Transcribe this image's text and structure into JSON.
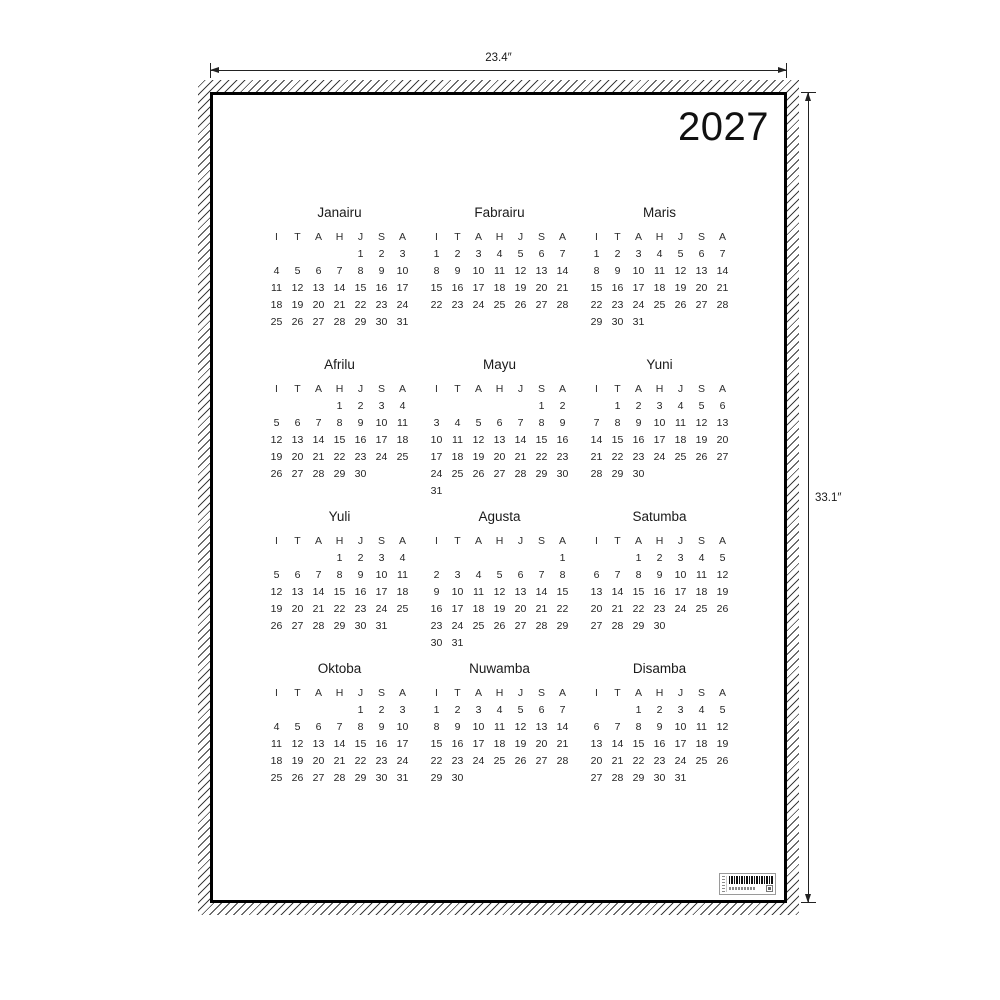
{
  "year": "2027",
  "dimensions": {
    "width_label": "23.4″",
    "height_label": "33.1″"
  },
  "calendar": {
    "day_letters": [
      "I",
      "T",
      "A",
      "H",
      "J",
      "S",
      "A"
    ],
    "months": [
      {
        "name": "Janairu",
        "weeks": [
          [
            "",
            "",
            "",
            "",
            1,
            2,
            3
          ],
          [
            4,
            5,
            6,
            7,
            8,
            9,
            10
          ],
          [
            11,
            12,
            13,
            14,
            15,
            16,
            17
          ],
          [
            18,
            19,
            20,
            21,
            22,
            23,
            24
          ],
          [
            25,
            26,
            27,
            28,
            29,
            30,
            31
          ]
        ]
      },
      {
        "name": "Fabrairu",
        "weeks": [
          [
            1,
            2,
            3,
            4,
            5,
            6,
            7
          ],
          [
            8,
            9,
            10,
            11,
            12,
            13,
            14
          ],
          [
            15,
            16,
            17,
            18,
            19,
            20,
            21
          ],
          [
            22,
            23,
            24,
            25,
            26,
            27,
            28
          ]
        ]
      },
      {
        "name": "Maris",
        "weeks": [
          [
            1,
            2,
            3,
            4,
            5,
            6,
            7
          ],
          [
            8,
            9,
            10,
            11,
            12,
            13,
            14
          ],
          [
            15,
            16,
            17,
            18,
            19,
            20,
            21
          ],
          [
            22,
            23,
            24,
            25,
            26,
            27,
            28
          ],
          [
            29,
            30,
            31,
            "",
            "",
            "",
            ""
          ]
        ]
      },
      {
        "name": "Afrilu",
        "weeks": [
          [
            "",
            "",
            "",
            1,
            2,
            3,
            4
          ],
          [
            5,
            6,
            7,
            8,
            9,
            10,
            11
          ],
          [
            12,
            13,
            14,
            15,
            16,
            17,
            18
          ],
          [
            19,
            20,
            21,
            22,
            23,
            24,
            25
          ],
          [
            26,
            27,
            28,
            29,
            30,
            "",
            ""
          ]
        ]
      },
      {
        "name": "Mayu",
        "weeks": [
          [
            "",
            "",
            "",
            "",
            "",
            1,
            2
          ],
          [
            3,
            4,
            5,
            6,
            7,
            8,
            9
          ],
          [
            10,
            11,
            12,
            13,
            14,
            15,
            16
          ],
          [
            17,
            18,
            19,
            20,
            21,
            22,
            23
          ],
          [
            24,
            25,
            26,
            27,
            28,
            29,
            30
          ],
          [
            31,
            "",
            "",
            "",
            "",
            "",
            ""
          ]
        ]
      },
      {
        "name": "Yuni",
        "weeks": [
          [
            "",
            1,
            2,
            3,
            4,
            5,
            6
          ],
          [
            7,
            8,
            9,
            10,
            11,
            12,
            13
          ],
          [
            14,
            15,
            16,
            17,
            18,
            19,
            20
          ],
          [
            21,
            22,
            23,
            24,
            25,
            26,
            27
          ],
          [
            28,
            29,
            30,
            "",
            "",
            "",
            ""
          ]
        ]
      },
      {
        "name": "Yuli",
        "weeks": [
          [
            "",
            "",
            "",
            1,
            2,
            3,
            4
          ],
          [
            5,
            6,
            7,
            8,
            9,
            10,
            11
          ],
          [
            12,
            13,
            14,
            15,
            16,
            17,
            18
          ],
          [
            19,
            20,
            21,
            22,
            23,
            24,
            25
          ],
          [
            26,
            27,
            28,
            29,
            30,
            31,
            ""
          ]
        ]
      },
      {
        "name": "Agusta",
        "weeks": [
          [
            "",
            "",
            "",
            "",
            "",
            "",
            1
          ],
          [
            2,
            3,
            4,
            5,
            6,
            7,
            8
          ],
          [
            9,
            10,
            11,
            12,
            13,
            14,
            15
          ],
          [
            16,
            17,
            18,
            19,
            20,
            21,
            22
          ],
          [
            23,
            24,
            25,
            26,
            27,
            28,
            29
          ],
          [
            30,
            31,
            "",
            "",
            "",
            "",
            ""
          ]
        ]
      },
      {
        "name": "Satumba",
        "weeks": [
          [
            "",
            "",
            1,
            2,
            3,
            4,
            5
          ],
          [
            6,
            7,
            8,
            9,
            10,
            11,
            12
          ],
          [
            13,
            14,
            15,
            16,
            17,
            18,
            19
          ],
          [
            20,
            21,
            22,
            23,
            24,
            25,
            26
          ],
          [
            27,
            28,
            29,
            30,
            "",
            "",
            ""
          ]
        ]
      },
      {
        "name": "Oktoba",
        "weeks": [
          [
            "",
            "",
            "",
            "",
            1,
            2,
            3
          ],
          [
            4,
            5,
            6,
            7,
            8,
            9,
            10
          ],
          [
            11,
            12,
            13,
            14,
            15,
            16,
            17
          ],
          [
            18,
            19,
            20,
            21,
            22,
            23,
            24
          ],
          [
            25,
            26,
            27,
            28,
            29,
            30,
            31
          ]
        ]
      },
      {
        "name": "Nuwamba",
        "weeks": [
          [
            1,
            2,
            3,
            4,
            5,
            6,
            7
          ],
          [
            8,
            9,
            10,
            11,
            12,
            13,
            14
          ],
          [
            15,
            16,
            17,
            18,
            19,
            20,
            21
          ],
          [
            22,
            23,
            24,
            25,
            26,
            27,
            28
          ],
          [
            29,
            30,
            "",
            "",
            "",
            "",
            ""
          ]
        ]
      },
      {
        "name": "Disamba",
        "weeks": [
          [
            "",
            "",
            1,
            2,
            3,
            4,
            5
          ],
          [
            6,
            7,
            8,
            9,
            10,
            11,
            12
          ],
          [
            13,
            14,
            15,
            16,
            17,
            18,
            19
          ],
          [
            20,
            21,
            22,
            23,
            24,
            25,
            26
          ],
          [
            27,
            28,
            29,
            30,
            31,
            "",
            ""
          ]
        ]
      }
    ]
  }
}
